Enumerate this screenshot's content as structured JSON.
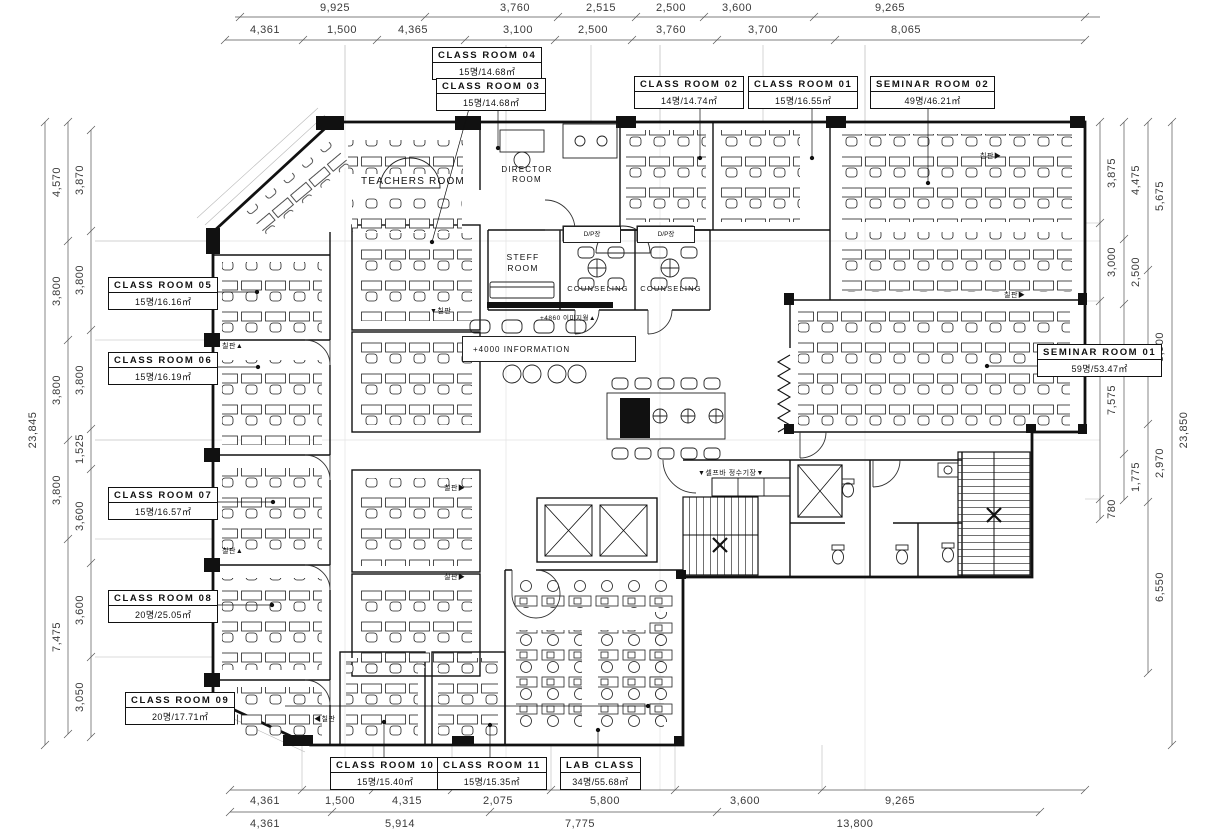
{
  "drawing": {
    "type": "architectural floor plan",
    "ink": "#111111",
    "dim_color": "#3a3a3a"
  },
  "rooms": {
    "cr04": {
      "name": "CLASS ROOM 04",
      "capacity": "15명/14.68㎡"
    },
    "cr03": {
      "name": "CLASS ROOM 03",
      "capacity": "15명/14.68㎡"
    },
    "cr02": {
      "name": "CLASS ROOM 02",
      "capacity": "14명/14.74㎡"
    },
    "cr01": {
      "name": "CLASS ROOM 01",
      "capacity": "15명/16.55㎡"
    },
    "sr02": {
      "name": "SEMINAR ROOM 02",
      "capacity": "49명/46.21㎡"
    },
    "sr01": {
      "name": "SEMINAR ROOM 01",
      "capacity": "59명/53.47㎡"
    },
    "cr05": {
      "name": "CLASS ROOM 05",
      "capacity": "15명/16.16㎡"
    },
    "cr06": {
      "name": "CLASS ROOM 06",
      "capacity": "15명/16.19㎡"
    },
    "cr07": {
      "name": "CLASS ROOM 07",
      "capacity": "15명/16.57㎡"
    },
    "cr08": {
      "name": "CLASS ROOM 08",
      "capacity": "20명/25.05㎡"
    },
    "cr09": {
      "name": "CLASS ROOM 09",
      "capacity": "20명/17.71㎡"
    },
    "cr10": {
      "name": "CLASS ROOM 10",
      "capacity": "15명/15.40㎡"
    },
    "cr11": {
      "name": "CLASS ROOM 11",
      "capacity": "15명/15.35㎡"
    },
    "lab": {
      "name": "LAB CLASS",
      "capacity": "34명/55.68㎡"
    }
  },
  "areas": {
    "teachers_room": "TEACHERS ROOM",
    "director_room": "DIRECTOR ROOM",
    "steff_room": "STEFF ROOM",
    "counseling": "COUNSELING",
    "dp_closet": "D/P장"
  },
  "annotations": {
    "information": "+4000 INFORMATION",
    "image_wall": "+4860 이미지월▲",
    "self_bar": "▼셀프바  정수기장▼",
    "board_down": "▼칠판",
    "board_up": "칠판▲",
    "board_left": "◀칠판",
    "board_right": "칠판▶"
  },
  "dims": {
    "top1": [
      "9,925",
      "3,760",
      "2,515",
      "2,500",
      "3,600",
      "9,265"
    ],
    "top2": [
      "4,361",
      "1,500",
      "4,365",
      "3,100",
      "2,500",
      "3,760",
      "3,700",
      "8,065"
    ],
    "bot1": [
      "4,361",
      "1,500",
      "4,315",
      "2,075",
      "5,800",
      "3,600",
      "9,265"
    ],
    "bot2": [
      "4,361",
      "5,914",
      "7,775",
      "13,800"
    ],
    "left_total": [
      "23,845"
    ],
    "left_mid": [
      "4,570",
      "3,800",
      "3,800",
      "3,800",
      "7,475"
    ],
    "left_inner": [
      "3,870",
      "3,800",
      "3,800",
      "1,525",
      "3,600",
      "3,600",
      "3,050"
    ],
    "right_inner": [
      "3,875",
      "3,000",
      "7,575",
      "780"
    ],
    "right_mid": [
      "4,475",
      "2,500",
      "1,775"
    ],
    "right_outer": [
      "5,675",
      "5,900",
      "2,970",
      "6,550"
    ],
    "right_total": [
      "23,850"
    ]
  }
}
